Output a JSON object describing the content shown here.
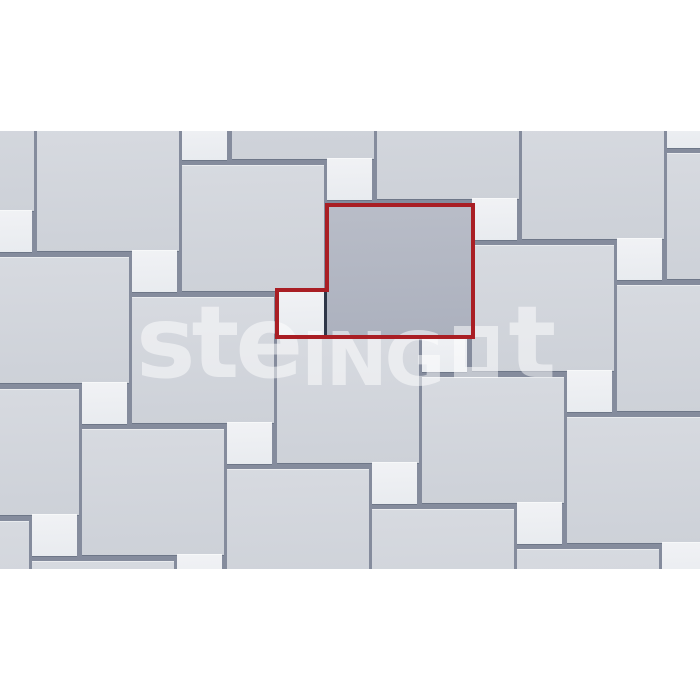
{
  "watermark": {
    "part1": "ste",
    "part2": "ING",
    "square_glyph": "square-outline-O",
    "part3": "t"
  },
  "colors": {
    "page_bg": "#ffffff",
    "joint": "#858c9d",
    "darkjoint": "#2e3648",
    "big1": "#d7dae0",
    "big2": "#cdd1d8",
    "small1": "#f1f2f5",
    "small2": "#e8ebef",
    "hl1": "#b9bdc8",
    "hl2": "#acb1be",
    "red": "#a91e24",
    "watermark": "rgba(255,255,255,0.5)"
  },
  "scene": {
    "top": 131,
    "height": 438,
    "width": 700
  },
  "tiles": {
    "sizes": {
      "big": {
        "w": 142,
        "h": 126
      },
      "small": {
        "w": 45,
        "h": 42
      }
    },
    "big_positions": [
      [
        232,
        -98
      ],
      [
        377,
        -58
      ],
      [
        522,
        -18
      ],
      [
        667,
        22
      ],
      [
        -108,
        -46
      ],
      [
        37,
        -6
      ],
      [
        182,
        34
      ],
      [
        472,
        114
      ],
      [
        617,
        154
      ],
      [
        -13,
        126
      ],
      [
        132,
        166
      ],
      [
        277,
        206
      ],
      [
        422,
        246
      ],
      [
        567,
        286
      ],
      [
        -63,
        258
      ],
      [
        82,
        298
      ],
      [
        227,
        338
      ],
      [
        372,
        378
      ],
      [
        517,
        418
      ],
      [
        -113,
        390
      ],
      [
        32,
        430
      ]
    ],
    "small_positions": [
      [
        667,
        -25
      ],
      [
        182,
        -13
      ],
      [
        327,
        27
      ],
      [
        472,
        67
      ],
      [
        617,
        107
      ],
      [
        -13,
        79
      ],
      [
        132,
        119
      ],
      [
        422,
        199
      ],
      [
        567,
        239
      ],
      [
        82,
        251
      ],
      [
        227,
        291
      ],
      [
        372,
        331
      ],
      [
        517,
        371
      ],
      [
        662,
        411
      ],
      [
        32,
        383
      ],
      [
        177,
        423
      ]
    ]
  },
  "highlighted_module": {
    "big": {
      "x": 327,
      "y": 74,
      "w": 145,
      "h": 130
    },
    "small": {
      "x": 277,
      "y": 159,
      "w": 47,
      "h": 45
    },
    "inner_joint": {
      "x": 324,
      "y": 159,
      "w": 3,
      "h": 45
    },
    "outline_points": "327,74 473,74 473,206 277,206 277,159 327,159",
    "outline_stroke_width": 4
  }
}
